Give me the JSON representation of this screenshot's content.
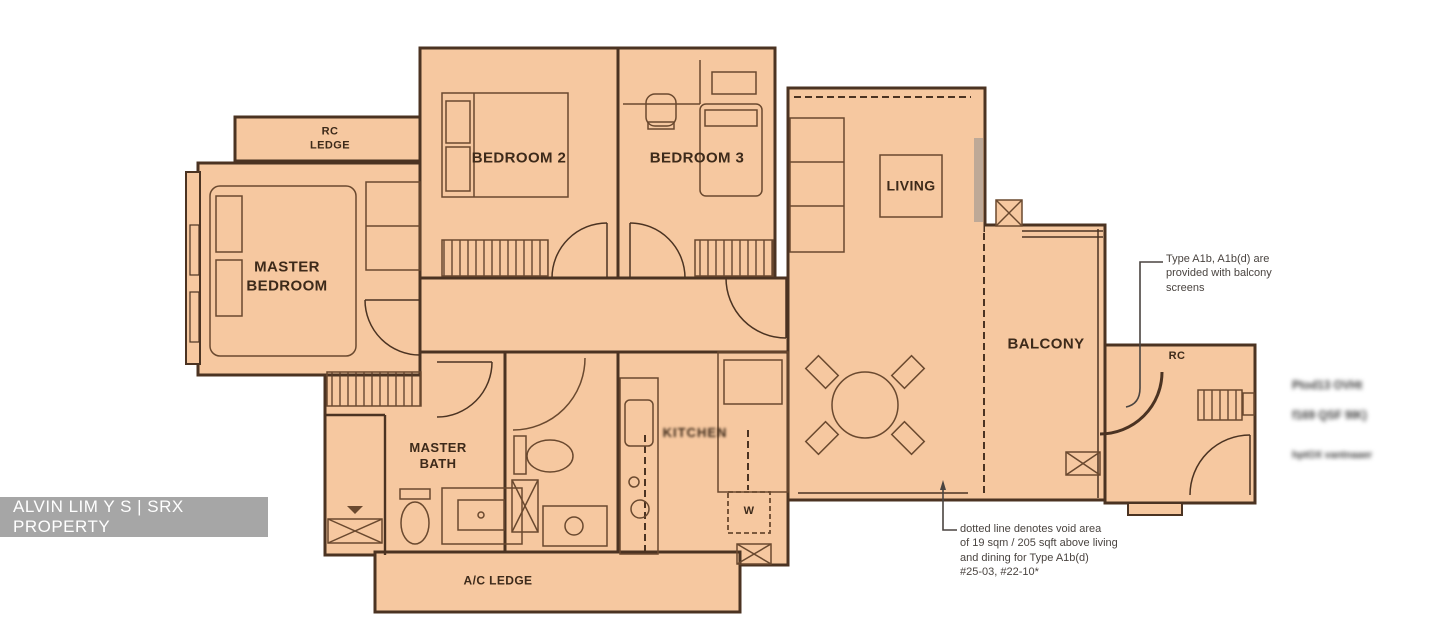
{
  "watermark": {
    "text": "ALVIN LIM Y S | SRX PROPERTY"
  },
  "rooms": {
    "rc_ledge": "RC\nLEDGE",
    "master_bedroom": "MASTER\nBEDROOM",
    "bedroom_2": "BEDROOM 2",
    "bedroom_3": "BEDROOM 3",
    "living": "LIVING",
    "balcony": "BALCONY",
    "rc": "RC",
    "kitchen": "KITCHEN",
    "master_bath": "MASTER\nBATH",
    "ac_ledge": "A/C LEDGE",
    "washer": "W"
  },
  "annotations": {
    "balcony_note": "Type A1b, A1b(d) are\nprovided with balcony\nscreens",
    "void_note": "dotted line denotes void area\nof 19 sqm / 205 sqft above living\nand dining for Type A1b(d)\n#25-03, #22-10*"
  },
  "obscured_text": {
    "line1": "Ptod13 OVHt",
    "line2": "f169 QSF 9IK)",
    "line3": "hptOX vantnaaer"
  },
  "colors": {
    "background": "#ffffff",
    "floor_fill": "#f6c8a0",
    "wall_line": "#4b3322",
    "furniture_line": "#6a492f",
    "label_text": "#3d2a1a",
    "annotation_text": "#4a4440",
    "watermark_bg": "#9e9e9e",
    "watermark_text": "#ffffff"
  }
}
